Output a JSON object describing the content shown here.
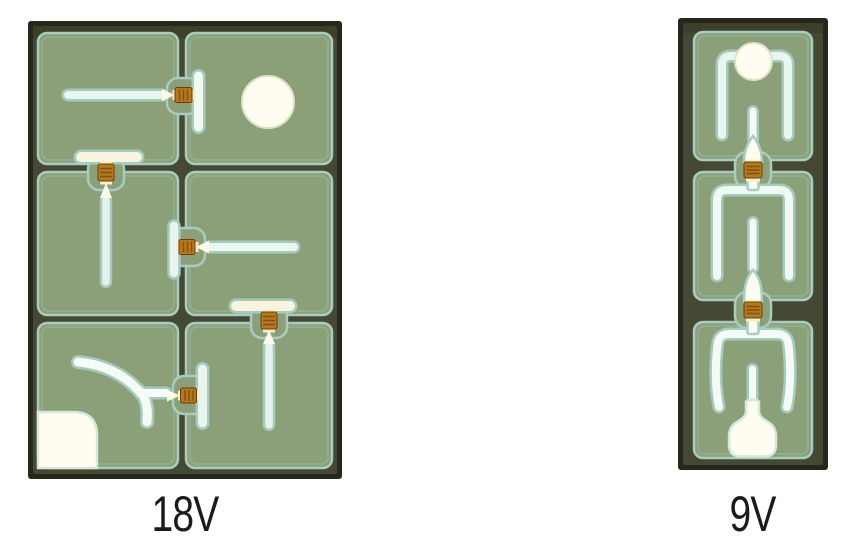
{
  "figure": {
    "type": "chip-micrograph-comparison",
    "chips": [
      {
        "label": "18V",
        "grid": "2x3",
        "cell_count": 6,
        "fuse_count": 5,
        "pads": [
          "circle-bond-pad",
          "square-bond-pad"
        ]
      },
      {
        "label": "9V",
        "grid": "1x3",
        "cell_count": 3,
        "fuse_count": 2,
        "pads": [
          "circle-bond-pad",
          "bell-bond-pad"
        ]
      }
    ],
    "palette": {
      "background": "#ffffff",
      "die_frame": "#25281b",
      "street": "#454833",
      "cell_fill": "#8ba079",
      "cell_outline": "#a8cdc0",
      "trace_cool": "#e7f6ef",
      "trace_warm": "#f8f4e0",
      "trace_glow": "#a8cec2",
      "fuse_orange": "#b9771c",
      "fuse_edge": "#5e430f",
      "pad_white": "#fffdf1",
      "label_color": "#1b1b1b"
    }
  }
}
